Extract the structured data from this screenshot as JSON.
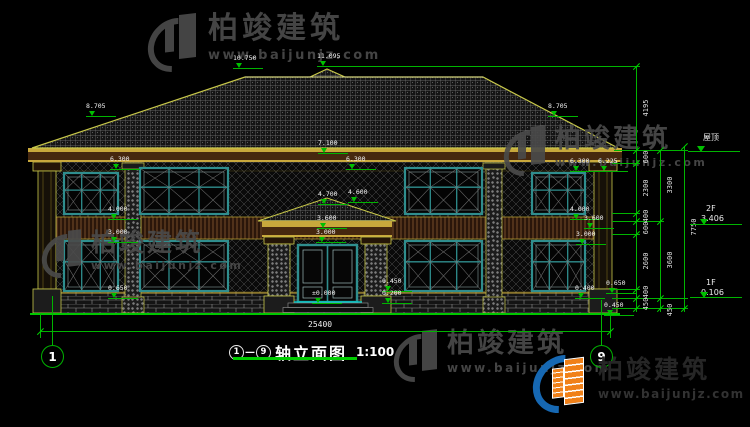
{
  "title": {
    "from_axis": "1",
    "separator": "—",
    "to_axis": "9",
    "text": "轴立面图",
    "scale": "1:100"
  },
  "axes": {
    "left_bubble": "1",
    "right_bubble": "9"
  },
  "elevation_markers": [
    "10.750",
    "11.095",
    "8.705",
    "8.705",
    "7.100",
    "6.300",
    "6.300",
    "6.300",
    "6.225",
    "4.700",
    "4.600",
    "4.000",
    "4.000",
    "3.600",
    "3.600",
    "3.000",
    "3.000",
    "3.000",
    "±0.000",
    "0.450",
    "0.200",
    "0.650",
    "0.400",
    "0.650",
    "0.450"
  ],
  "dimensions": {
    "overall_width": "25400",
    "chain_inner": [
      "4195",
      "600",
      "2300",
      "400",
      "600",
      "2600",
      "400",
      "450"
    ],
    "chain_mid": [
      "3300",
      "3600",
      "450"
    ],
    "chain_outer": [
      "7750"
    ]
  },
  "levels": {
    "roof": "屋顶",
    "f2_label": "2F",
    "f2_value": "3.406",
    "f1_label": "1F",
    "f1_value": "0.106"
  },
  "watermark": {
    "brand": "柏竣建筑",
    "url": "www.baijunjz.com"
  },
  "footer_logo": {
    "brand": "柏竣建筑",
    "url": "www.baijunjz.com"
  },
  "colors": {
    "dimension_green": "#00c000",
    "trim_yellow": "#c8c84a",
    "window_teal": "#2f8e8e",
    "eaves_brown": "#46280f",
    "logo_blue": "#1668b3",
    "logo_orange": "#f08018"
  }
}
